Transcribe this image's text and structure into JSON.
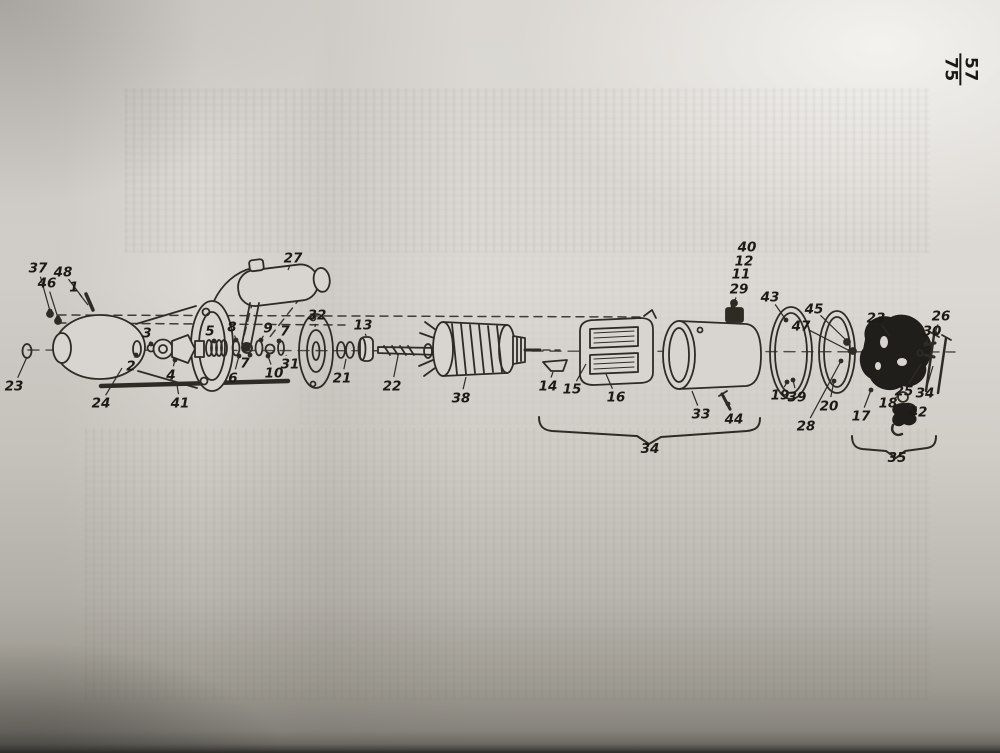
{
  "page": {
    "number_top": "57",
    "number_bottom": "75"
  },
  "figure": {
    "braces": {
      "large_label": "34",
      "small_label": "35"
    },
    "callouts": [
      {
        "n": "37",
        "x": 38,
        "y": 268,
        "tx": 50,
        "ty": 311,
        "dot": true
      },
      {
        "n": "46",
        "x": 47,
        "y": 283,
        "tx": 58,
        "ty": 318,
        "dot": true
      },
      {
        "n": "48",
        "x": 63,
        "y": 272,
        "tx": 82,
        "ty": 297,
        "dot": false
      },
      {
        "n": "1",
        "x": 74,
        "y": 287,
        "tx": 88,
        "ty": 305,
        "dot": false
      },
      {
        "n": "23",
        "x": 14,
        "y": 386,
        "tx": 27,
        "ty": 357,
        "dot": false
      },
      {
        "n": "24",
        "x": 101,
        "y": 403,
        "tx": 122,
        "ty": 368,
        "dot": false
      },
      {
        "n": "2",
        "x": 131,
        "y": 366,
        "tx": 136,
        "ty": 355,
        "dot": true
      },
      {
        "n": "3",
        "x": 147,
        "y": 333,
        "tx": 151,
        "ty": 344,
        "dot": true
      },
      {
        "n": "4",
        "x": 171,
        "y": 375,
        "tx": 175,
        "ty": 360,
        "dot": true
      },
      {
        "n": "5",
        "x": 210,
        "y": 331,
        "tx": 214,
        "ty": 341,
        "dot": true
      },
      {
        "n": "8",
        "x": 232,
        "y": 327,
        "tx": 236,
        "ty": 340,
        "dot": true
      },
      {
        "n": "9",
        "x": 268,
        "y": 328,
        "tx": 261,
        "ty": 340,
        "dot": true
      },
      {
        "n": "7",
        "x": 285,
        "y": 331,
        "tx": 279,
        "ty": 341,
        "dot": true
      },
      {
        "n": "6",
        "x": 233,
        "y": 378,
        "tx": 239,
        "ty": 356,
        "dot": true
      },
      {
        "n": "7",
        "x": 245,
        "y": 363,
        "tx": 250,
        "ty": 355,
        "dot": true
      },
      {
        "n": "10",
        "x": 274,
        "y": 373,
        "tx": 268,
        "ty": 356,
        "dot": true
      },
      {
        "n": "31",
        "x": 290,
        "y": 364,
        "tx": 286,
        "ty": 355,
        "dot": false
      },
      {
        "n": "27",
        "x": 293,
        "y": 258,
        "tx": 288,
        "ty": 270,
        "dot": false
      },
      {
        "n": "32",
        "x": 317,
        "y": 315,
        "tx": 315,
        "ty": 327,
        "dot": false
      },
      {
        "n": "13",
        "x": 363,
        "y": 325,
        "tx": 366,
        "ty": 336,
        "dot": false
      },
      {
        "n": "21",
        "x": 342,
        "y": 378,
        "tx": 346,
        "ty": 359,
        "dot": false
      },
      {
        "n": "22",
        "x": 392,
        "y": 386,
        "tx": 398,
        "ty": 356,
        "dot": false
      },
      {
        "n": "38",
        "x": 461,
        "y": 398,
        "tx": 466,
        "ty": 377,
        "dot": false
      },
      {
        "n": "14",
        "x": 548,
        "y": 386,
        "tx": 553,
        "ty": 372,
        "dot": false
      },
      {
        "n": "15",
        "x": 572,
        "y": 389,
        "tx": 586,
        "ty": 364,
        "dot": false
      },
      {
        "n": "16",
        "x": 616,
        "y": 397,
        "tx": 606,
        "ty": 374,
        "dot": false
      },
      {
        "n": "40",
        "x": 747,
        "y": 247
      },
      {
        "n": "12",
        "x": 744,
        "y": 261
      },
      {
        "n": "11",
        "x": 741,
        "y": 274
      },
      {
        "n": "29",
        "x": 739,
        "y": 289,
        "tx": 733,
        "ty": 306,
        "dot": true
      },
      {
        "n": "43",
        "x": 770,
        "y": 297,
        "tx": 786,
        "ty": 320,
        "dot": true
      },
      {
        "n": "45",
        "x": 814,
        "y": 309,
        "tx": 847,
        "ty": 341,
        "dot": true
      },
      {
        "n": "47",
        "x": 801,
        "y": 326,
        "tx": 850,
        "ty": 351,
        "dot": true
      },
      {
        "n": "33",
        "x": 701,
        "y": 414,
        "tx": 692,
        "ty": 391,
        "dot": false
      },
      {
        "n": "44",
        "x": 734,
        "y": 419,
        "tx": 728,
        "ty": 404,
        "dot": true
      },
      {
        "n": "19",
        "x": 780,
        "y": 395,
        "tx": 787,
        "ty": 382,
        "dot": true
      },
      {
        "n": "39",
        "x": 797,
        "y": 397,
        "tx": 793,
        "ty": 380,
        "dot": true
      },
      {
        "n": "20",
        "x": 829,
        "y": 406,
        "tx": 834,
        "ty": 381,
        "dot": true
      },
      {
        "n": "28",
        "x": 806,
        "y": 426,
        "tx": 841,
        "ty": 361,
        "dot": true
      },
      {
        "n": "23",
        "x": 876,
        "y": 318,
        "tx": 890,
        "ty": 336,
        "dot": false
      },
      {
        "n": "17",
        "x": 861,
        "y": 416,
        "tx": 871,
        "ty": 390,
        "dot": true
      },
      {
        "n": "18",
        "x": 888,
        "y": 403,
        "tx": 898,
        "ty": 396,
        "dot": false
      },
      {
        "n": "42",
        "x": 918,
        "y": 412,
        "tx": 909,
        "ty": 404,
        "dot": false
      },
      {
        "n": "25",
        "x": 904,
        "y": 391,
        "tx": 921,
        "ty": 364,
        "dot": false
      },
      {
        "n": "34",
        "x": 925,
        "y": 393,
        "tx": 933,
        "ty": 366,
        "dot": false
      },
      {
        "n": "26",
        "x": 941,
        "y": 316,
        "tx": 935,
        "ty": 333,
        "dot": true
      },
      {
        "n": "30",
        "x": 932,
        "y": 331,
        "tx": 926,
        "ty": 344,
        "dot": true
      },
      {
        "n": "41",
        "x": 180,
        "y": 403,
        "tx": 177,
        "ty": 385,
        "dot": false
      }
    ]
  }
}
